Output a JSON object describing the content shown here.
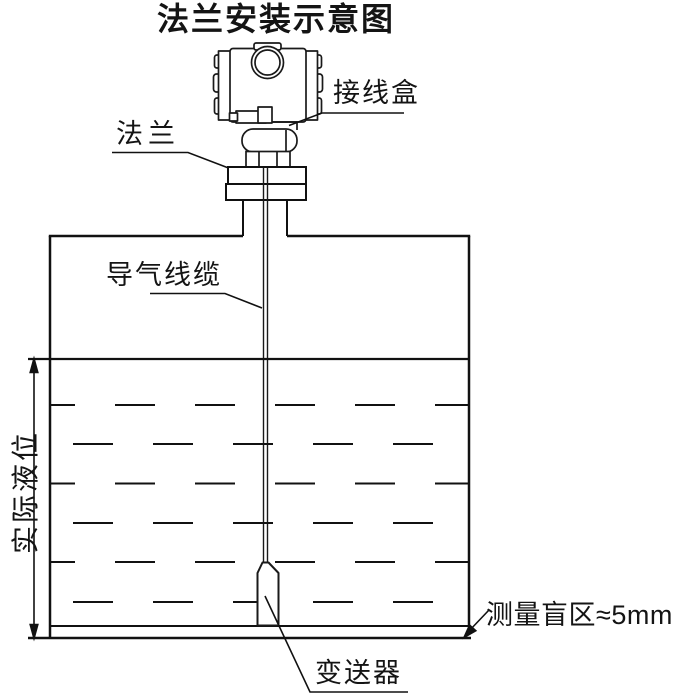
{
  "title": "法兰安装示意图",
  "labels": {
    "junction_box": "接线盒",
    "flange": "法兰",
    "air_cable": "导气线缆",
    "actual_level": "实际液位",
    "transmitter": "变送器",
    "blind_zone": "测量盲区≈5mm"
  },
  "colors": {
    "line": "#1a1a1a",
    "background": "#ffffff"
  }
}
